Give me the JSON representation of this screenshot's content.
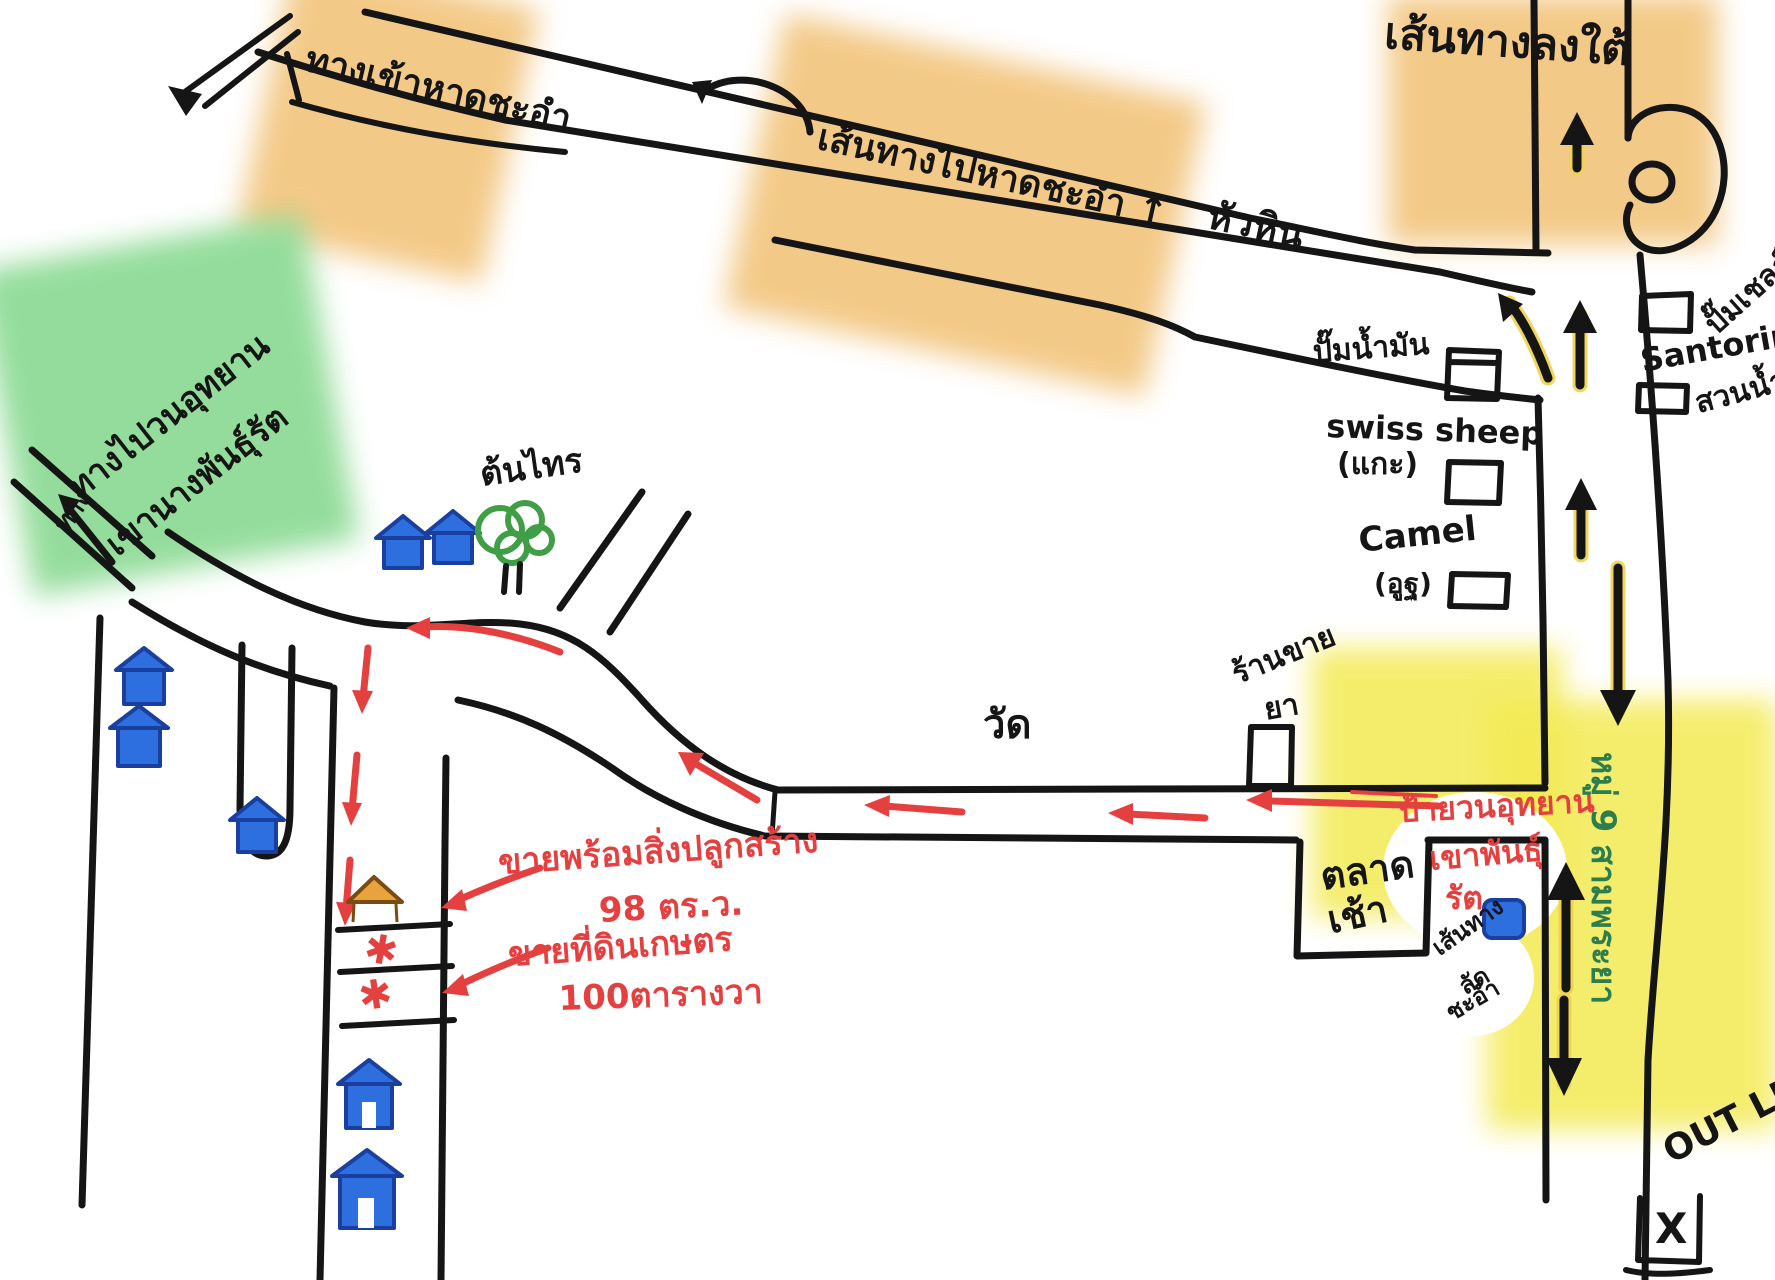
{
  "labels": {
    "beach_entrance": "ทางเข้าหาดชะอำ",
    "beach_route": "เส้นทางไปหาดชะอำ ↑",
    "huahin": "หัวหิน",
    "south_route": "เส้นทางลงใต้",
    "shell_station": "ปั๊มเชลล์",
    "santorini": "Santorini",
    "water_park": "สวนน้ำ",
    "gas_station": "ปั๊มน้ำมัน",
    "swiss_sheep": "swiss sheep",
    "sheep_thai": "(แกะ)",
    "camel": "Camel",
    "camel_thai": "(อูฐ)",
    "temple": "วัด",
    "pharmacy_1": "ร้านขาย",
    "pharmacy_2": "ยา",
    "market_1": "ตลาด",
    "market_2": "เช้า",
    "park_sign_1": "ป้ายวนอุทยาน",
    "park_sign_2": "เขาพันธุ์",
    "park_sign_3": "รัต",
    "shortcut_1": "เส้นทาง",
    "shortcut_2": "ลัด",
    "shortcut_3": "ชะอำ",
    "village_road": "หมู่ 9 สามพระยา",
    "park_way_1": "ทางไปวนอุทยาน",
    "park_way_2": "เขานางพันธุ์รัต",
    "park_way_3": "ทาง",
    "banyan_tree": "ต้นไทร",
    "sale_house_1": "ขายพร้อมสิ่งปลูกสร้าง",
    "sale_house_2": "98 ตร.ว.",
    "sale_land_1": "ขายที่ดินเกษตร",
    "sale_land_2": "100ตารางวา",
    "outlet": "OUT LET",
    "x_mark": "X",
    "star": "✱"
  },
  "colors": {
    "ink": "#151515",
    "route_red": "#e4403f",
    "highlight_orange": "#f2c47c",
    "highlight_green": "#8fdb97",
    "highlight_yellow": "#f3ea52",
    "arrow_yellow": "#f0d24a",
    "house_blue": "#2e6fe0",
    "house_orange": "#e8a33d",
    "tree_green": "#3f9e46",
    "text_green": "#2e7d4f"
  }
}
